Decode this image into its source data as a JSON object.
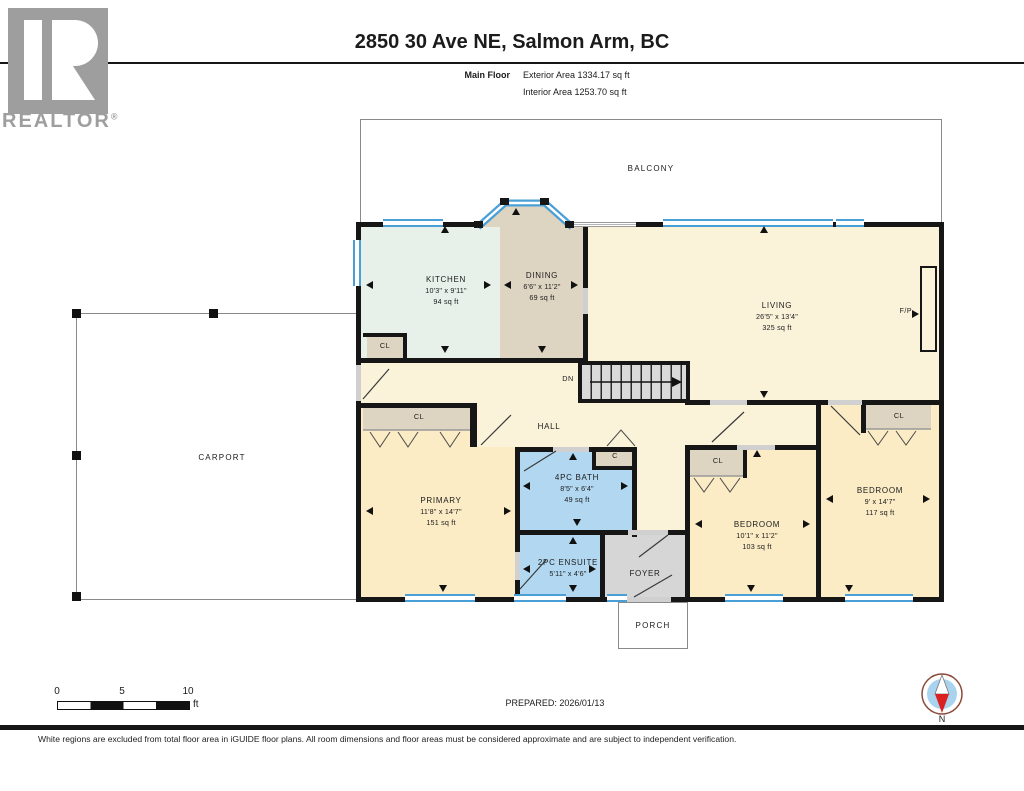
{
  "header": {
    "title": "2850 30 Ave NE, Salmon Arm, BC",
    "floor_label": "Main Floor",
    "exterior_area": "Exterior Area 1334.17 sq ft",
    "interior_area": "Interior Area 1253.70 sq ft"
  },
  "logo": {
    "text": "REALTOR",
    "registered": "®"
  },
  "rooms": {
    "balcony": {
      "name": "BALCONY"
    },
    "kitchen": {
      "name": "KITCHEN",
      "dims": "10'3\" x 9'11\"",
      "area": "94 sq ft"
    },
    "dining": {
      "name": "DINING",
      "dims": "6'6\" x 11'2\"",
      "area": "69 sq ft"
    },
    "living": {
      "name": "LIVING",
      "dims": "26'5\" x 13'4\"",
      "area": "325 sq ft"
    },
    "hall": {
      "name": "HALL"
    },
    "carport": {
      "name": "CARPORT"
    },
    "primary": {
      "name": "PRIMARY",
      "dims": "11'8\" x 14'7\"",
      "area": "151 sq ft"
    },
    "bath4pc": {
      "name": "4PC BATH",
      "dims": "8'5\" x 6'4\"",
      "area": "49 sq ft"
    },
    "ensuite2pc": {
      "name": "2PC ENSUITE",
      "dims": "5'11\" x 4'6\""
    },
    "foyer": {
      "name": "FOYER"
    },
    "bedroom_mid": {
      "name": "BEDROOM",
      "dims": "10'1\" x 11'2\"",
      "area": "103 sq ft"
    },
    "bedroom_right": {
      "name": "BEDROOM",
      "dims": "9' x 14'7\"",
      "area": "117 sq ft"
    },
    "porch": {
      "name": "PORCH"
    }
  },
  "labels": {
    "closet": "CL",
    "closet_small": "C",
    "stairs_down": "DN",
    "fireplace": "F/P"
  },
  "scale_bar": {
    "tick0": "0",
    "tick5": "5",
    "tick10": "10",
    "unit": "ft"
  },
  "prepared": "PREPARED: 2026/01/13",
  "compass": {
    "north": "N"
  },
  "disclaimer": "White regions are excluded from total floor area in iGUIDE floor plans. All room dimensions and floor areas must be considered approximate and are subject to independent verification.",
  "colors": {
    "wall": "#161616",
    "cream": "#faf3da",
    "bedroom": "#fbecc5",
    "kitchen": "#e7f1ea",
    "dining_closet": "#ded4c2",
    "bath": "#b2d8f1",
    "foyer_gray": "#d6d6d6",
    "stairs_gray": "#dadada",
    "window_blue": "#4aa0d6",
    "door_gray": "#d0d0d0",
    "compass_blue": "#a9d3ee",
    "needle_red": "#d92121",
    "logo_gray": "#9e9e9e"
  }
}
